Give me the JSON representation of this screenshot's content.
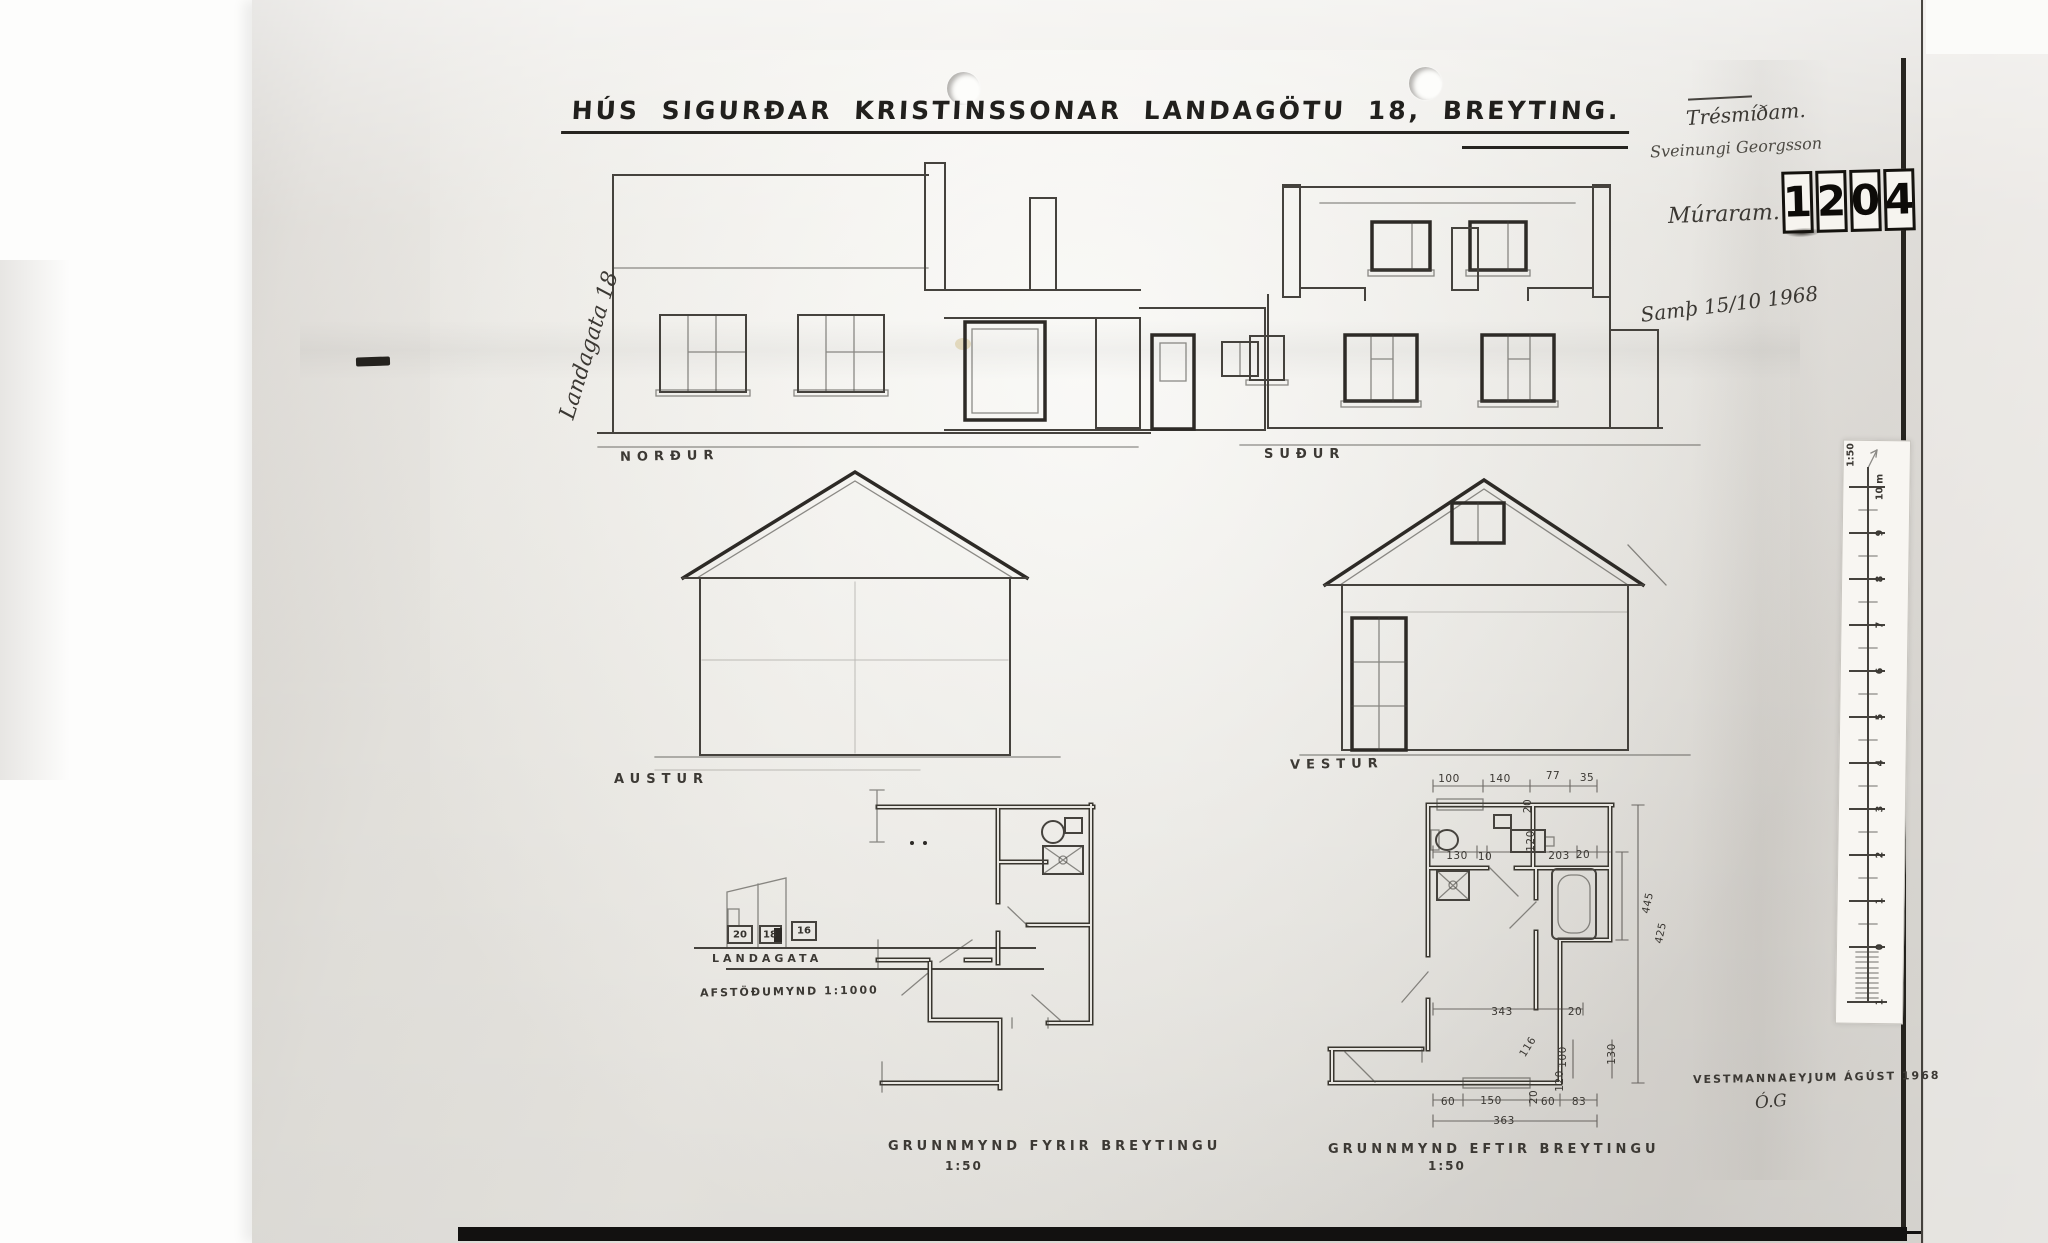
{
  "document": {
    "title": "HÚS SIGURÐAR KRISTINSSONAR LANDAGÖTU 18, BREYTING.",
    "approval_note": "Samþ 15/10 1968",
    "place_date": "VESTMANNAEYJUM ÁGÚST 1968",
    "signature": "Ó.G",
    "street_note": "Landagata 18",
    "notes": {
      "carpenter_label": "Trésmíðam.",
      "carpenter_name": "Sveinungi Georgsson",
      "mason_label": "Múraram."
    },
    "stamp": {
      "digits": [
        "1",
        "2",
        "0",
        "4"
      ]
    }
  },
  "elevations": {
    "north": "NORÐUR",
    "south": "SUÐUR",
    "east": "AUSTUR",
    "west": "VESTUR"
  },
  "site_plan": {
    "street": "LANDAGATA",
    "caption": "AFSTÖÐUMYND 1:1000",
    "lots": [
      "20",
      "18",
      "16"
    ]
  },
  "floor_plans": {
    "before": {
      "caption": "GRUNNMYND FYRIR BREYTINGU",
      "scale": "1:50"
    },
    "after": {
      "caption": "GRUNNMYND EFTIR BREYTINGU",
      "scale": "1:50"
    },
    "after_dimensions": [
      {
        "t": "100",
        "x": 1449,
        "y": 779
      },
      {
        "t": "140",
        "x": 1500,
        "y": 779
      },
      {
        "t": "77",
        "x": 1553,
        "y": 776
      },
      {
        "t": "35",
        "x": 1587,
        "y": 778
      },
      {
        "t": "20",
        "x": 1528,
        "y": 806,
        "r": -90
      },
      {
        "t": "130",
        "x": 1457,
        "y": 856
      },
      {
        "t": "10",
        "x": 1485,
        "y": 857
      },
      {
        "t": "120",
        "x": 1531,
        "y": 841,
        "r": -90
      },
      {
        "t": "203",
        "x": 1559,
        "y": 856
      },
      {
        "t": "20",
        "x": 1583,
        "y": 855
      },
      {
        "t": "445",
        "x": 1648,
        "y": 903,
        "r": -78
      },
      {
        "t": "425",
        "x": 1661,
        "y": 933,
        "r": -78
      },
      {
        "t": "343",
        "x": 1502,
        "y": 1012
      },
      {
        "t": "20",
        "x": 1575,
        "y": 1012
      },
      {
        "t": "116",
        "x": 1528,
        "y": 1047,
        "r": -58
      },
      {
        "t": "100",
        "x": 1563,
        "y": 1057,
        "r": -90
      },
      {
        "t": "130",
        "x": 1612,
        "y": 1054,
        "r": -90
      },
      {
        "t": "120",
        "x": 1560,
        "y": 1081,
        "r": -90
      },
      {
        "t": "60",
        "x": 1448,
        "y": 1102
      },
      {
        "t": "150",
        "x": 1491,
        "y": 1101
      },
      {
        "t": "20",
        "x": 1534,
        "y": 1097,
        "r": -90
      },
      {
        "t": "60",
        "x": 1548,
        "y": 1102
      },
      {
        "t": "83",
        "x": 1579,
        "y": 1102
      },
      {
        "t": "363",
        "x": 1504,
        "y": 1121
      }
    ]
  },
  "ruler": {
    "scale_label": "1:50",
    "marks": [
      "10 m",
      "9",
      "8",
      "7",
      "6",
      "5",
      "4",
      "3",
      "2",
      "1",
      "0",
      "1"
    ]
  }
}
